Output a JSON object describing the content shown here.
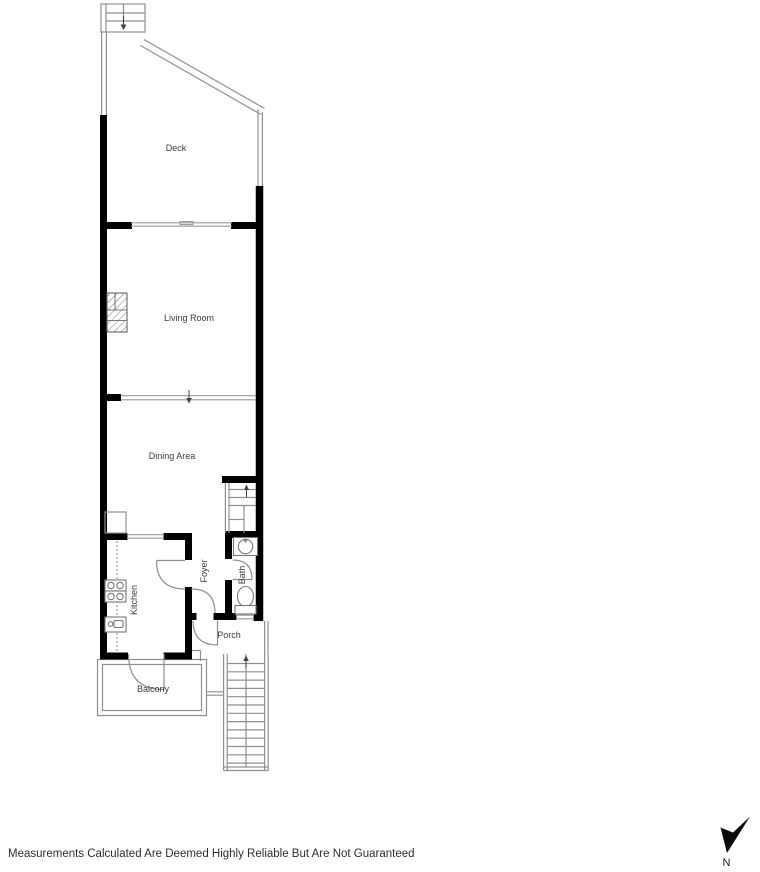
{
  "floorplan": {
    "rooms": {
      "deck": "Deck",
      "living_room": "Living Room",
      "dining_area": "Dining Area",
      "kitchen": "Kitchen",
      "foyer": "Foyer",
      "bath": "Bath",
      "porch": "Porch",
      "balcony": "Balcony"
    },
    "colors": {
      "wall": "#000000",
      "thin_line": "#8f8f8f",
      "window_line": "#9a9a9a",
      "fixture_line": "#777777",
      "label_text": "#3a3a3a",
      "background": "#ffffff"
    }
  },
  "compass": {
    "north_label": "N"
  },
  "footer": {
    "disclaimer": "Measurements Calculated Are Deemed Highly Reliable But Are Not Guaranteed"
  }
}
